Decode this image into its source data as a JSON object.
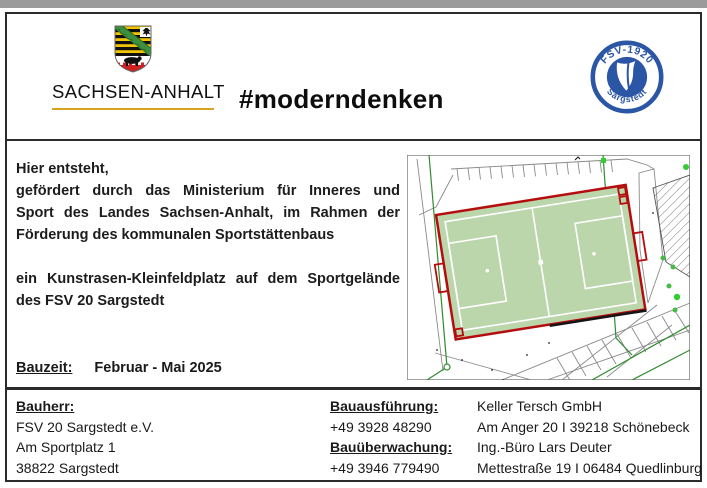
{
  "header": {
    "state_name": "SACHSEN-ANHALT",
    "hashtag": "#moderndenken",
    "club_badge": {
      "top_text": "FSV-1920",
      "bottom_text": "Sargstedt"
    }
  },
  "main": {
    "message_lines": [
      "Hier entsteht,",
      "gefördert durch das Ministerium für Inneres und",
      "Sport des Landes Sachsen-Anhalt, im Rahmen der",
      "Förderung des kommunalen Sportstättenbaus",
      "ein Kunstrasen-Kleinfeldplatz auf dem Sportgelände",
      "des FSV 20 Sargstedt"
    ],
    "bauzeit_label": "Bauzeit:",
    "bauzeit_value": "Februar - Mai 2025"
  },
  "footer": {
    "bauherr_label": "Bauherr:",
    "bauherr_lines": [
      "FSV 20 Sargstedt e.V.",
      "Am Sportplatz 1",
      "38822 Sargstedt"
    ],
    "bauausfuehrung_label": "Bauausführung:",
    "bauausfuehrung_phone": "+49 3928 48290",
    "bauueberwachung_label": "Bauüberwachung:",
    "bauueberwachung_phone": "+49 3946 779490",
    "companies": [
      "Keller Tersch GmbH",
      "Am Anger 20 I 39218 Schönebeck",
      "Ing.-Büro Lars Deuter",
      "Mettestraße 19 I 06484 Quedlinburg"
    ]
  },
  "colors": {
    "accent_gold": "#d9a520",
    "club_blue": "#2b55a5",
    "field_green": "#bcd6ac",
    "plan_red": "#b50d0d",
    "boundary_green": "#2e8b2e"
  }
}
